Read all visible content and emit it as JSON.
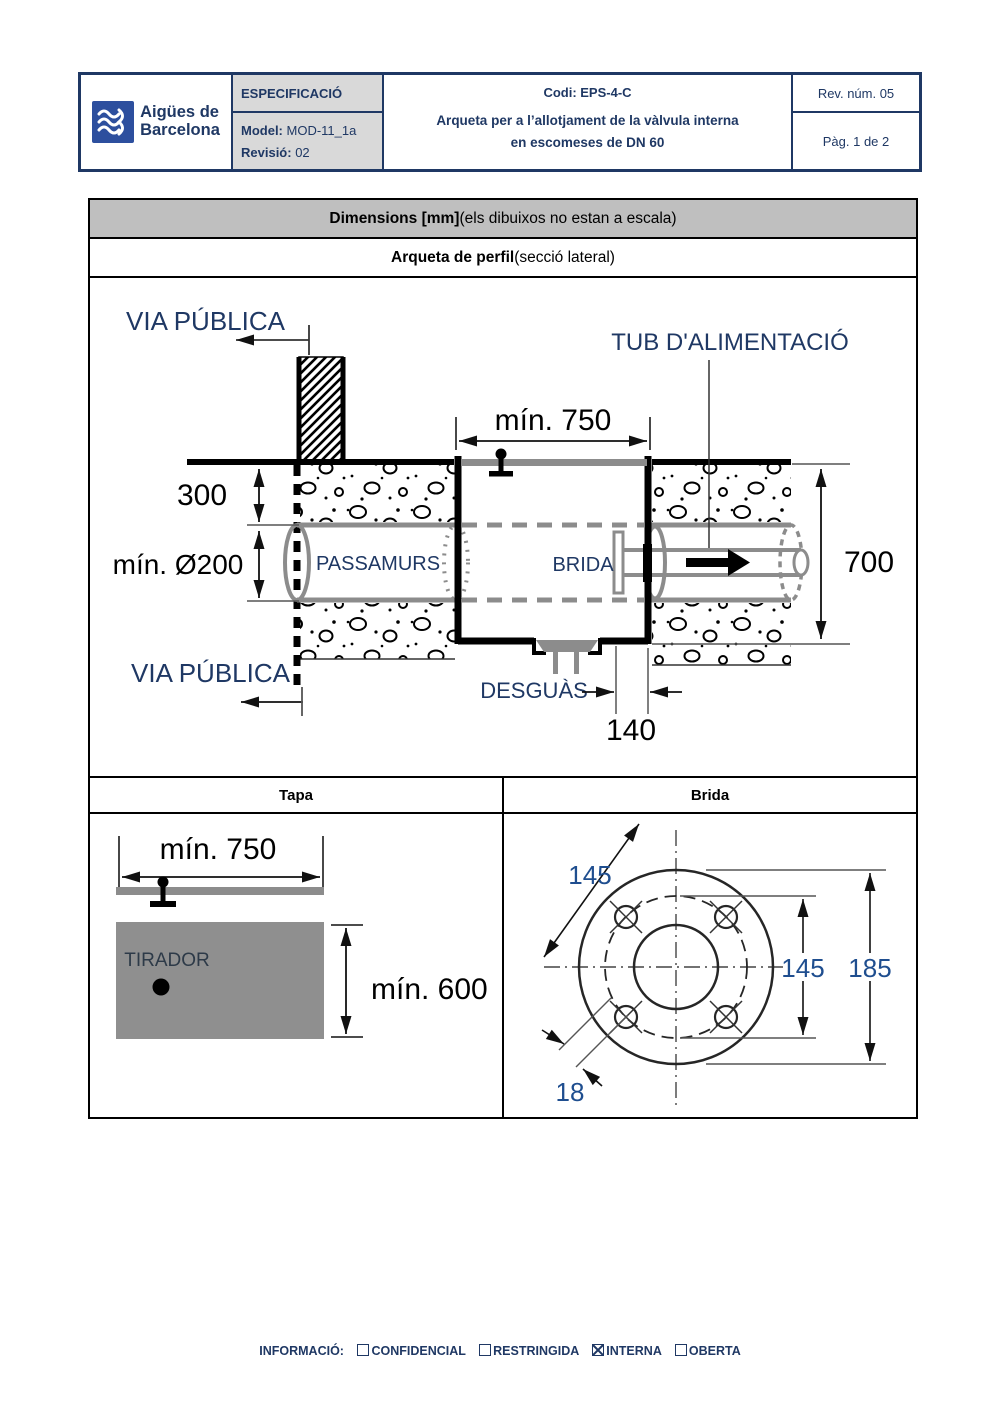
{
  "header": {
    "brand_line1": "Aigües de",
    "brand_line2": "Barcelona",
    "spec_label": "ESPECIFICACIÓ",
    "model_label": "Model:",
    "model_value": " MOD-11_1a",
    "revision_label": "Revisió:",
    "revision_value": " 02",
    "code": "Codi: EPS-4-C",
    "title_line1": "Arqueta per a l’allotjament de la vàlvula interna",
    "title_line2": "en escomeses de DN 60",
    "rev_num": "Rev. núm. 05",
    "page": "Pàg. 1 de 2"
  },
  "table": {
    "dimensions_bold": "Dimensions [mm]",
    "dimensions_rest": " (els dibuixos no estan a escala)",
    "section_bold": "Arqueta de perfil",
    "section_rest": " (secció lateral)",
    "tapa_header": "Tapa",
    "brida_header": "Brida"
  },
  "diagram_main": {
    "via_publica_top": "VIA PÚBLICA",
    "via_publica_bottom": "VIA PÚBLICA",
    "tub_alimentacio": "TUB D'ALIMENTACIÓ",
    "min_750": "mín. 750",
    "dim_300": "300",
    "min_o200": "mín. Ø200",
    "passamurs": "PASSAMURS",
    "brida": "BRIDA",
    "dim_700": "700",
    "desguas": "DESGUÀS",
    "dim_140": "140"
  },
  "diagram_tapa": {
    "min_750": "mín. 750",
    "tirador": "TIRADOR",
    "min_600": "mín. 600"
  },
  "diagram_brida": {
    "dim_145_diag": "145",
    "dim_145_right": "145",
    "dim_185": "185",
    "dim_18": "18"
  },
  "footer": {
    "label": "INFORMACIÓ:",
    "confidencial": "CONFIDENCIAL",
    "restringida": "RESTRINGIDA",
    "interna": "INTERNA",
    "oberta": "OBERTA"
  },
  "colors": {
    "navy": "#1f3864",
    "title_bar_gray": "#bfbfbf",
    "header_cell_gray": "#d9d9d9",
    "drawing_gray": "#8c8c8c",
    "dim_blue": "#1f4e8f",
    "logo_blue": "#2d4f9e"
  }
}
